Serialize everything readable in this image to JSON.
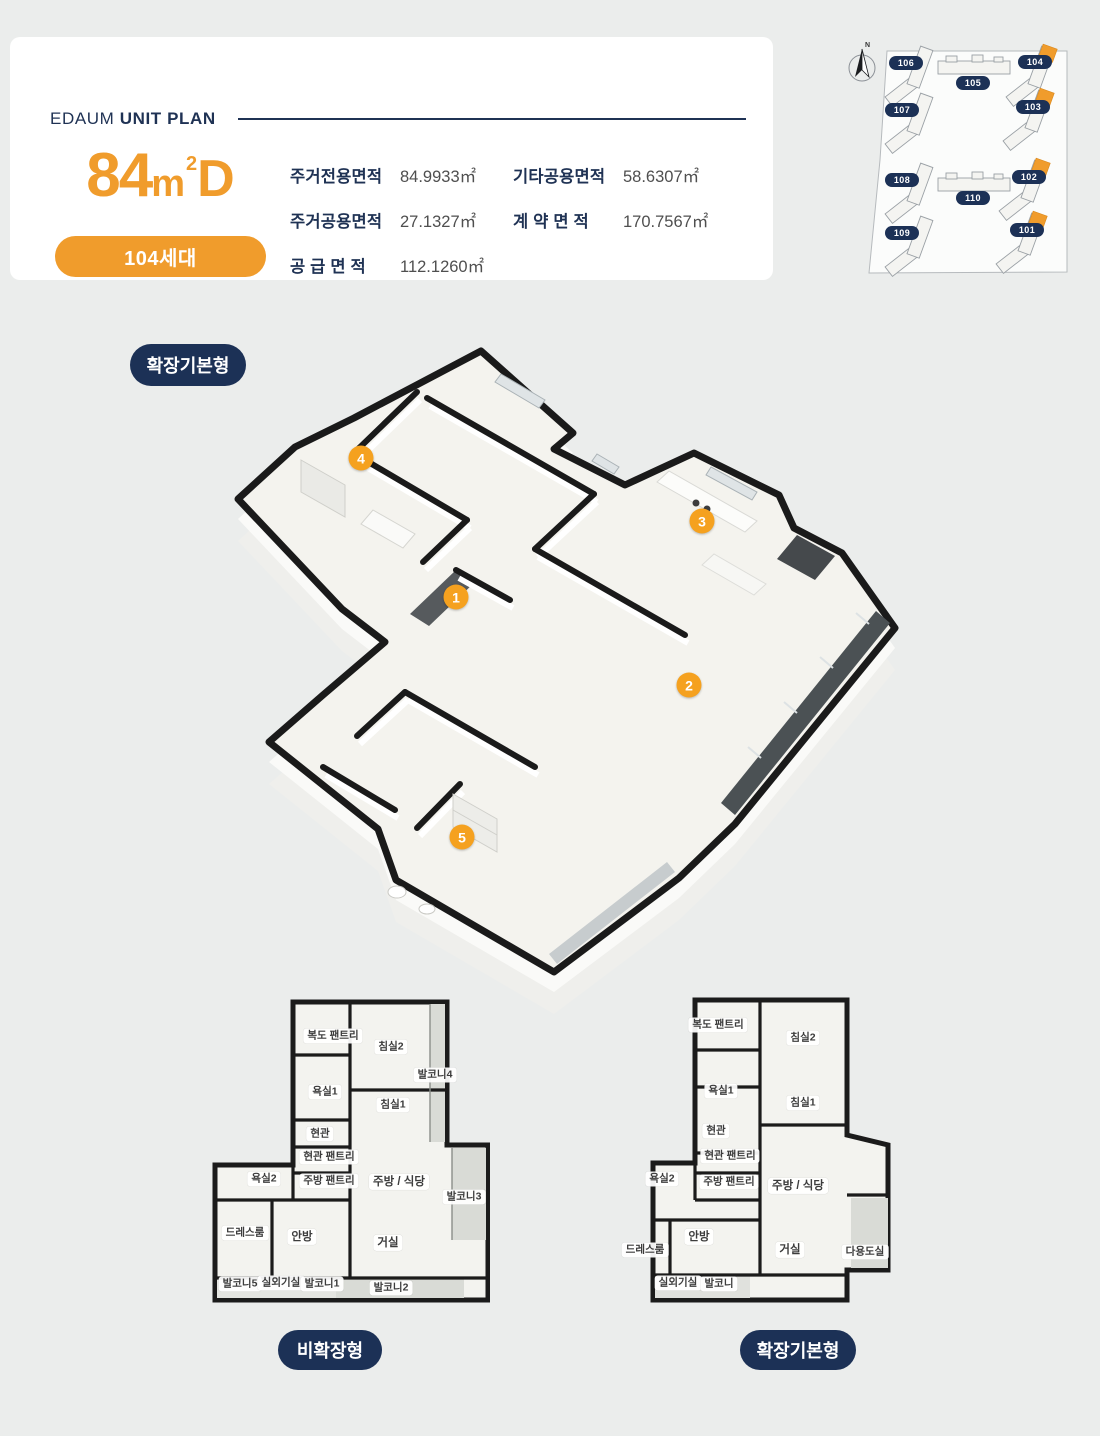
{
  "header": {
    "brand": "EDAUM",
    "title": "UNIT PLAN",
    "unit_size": "84",
    "unit_m": "m",
    "unit_sup": "2",
    "unit_type": "D",
    "households": "104세대",
    "areas": [
      {
        "label": "주거전용면적",
        "value": "84.9933㎡"
      },
      {
        "label": "기타공용면적",
        "value": "58.6307㎡"
      },
      {
        "label": "주거공용면적",
        "value": "27.1327㎡"
      },
      {
        "label": "계 약 면 적",
        "value": "170.7567㎡"
      },
      {
        "label": "공 급 면 적",
        "value": "112.1260㎡"
      }
    ]
  },
  "site_map": {
    "north": "N",
    "buildings": [
      "106",
      "105",
      "104",
      "107",
      "103",
      "108",
      "110",
      "102",
      "109",
      "101"
    ],
    "highlighted_buildings": [
      "104",
      "103",
      "102",
      "101"
    ]
  },
  "plan3d": {
    "badge": "확장기본형",
    "markers": [
      "1",
      "2",
      "3",
      "4",
      "5"
    ]
  },
  "plans": [
    {
      "badge": "비확장형",
      "rooms": [
        "복도 팬트리",
        "침실2",
        "발코니4",
        "욕실1",
        "침실1",
        "현관",
        "현관 팬트리",
        "욕실2",
        "주방 팬트리",
        "주방 / 식당",
        "발코니3",
        "드레스룸",
        "안방",
        "거실",
        "발코니5",
        "실외기실",
        "발코니1",
        "발코니2"
      ]
    },
    {
      "badge": "확장기본형",
      "rooms": [
        "복도 팬트리",
        "침실2",
        "욕실1",
        "침실1",
        "현관",
        "현관 팬트리",
        "욕실2",
        "주방 팬트리",
        "주방 / 식당",
        "드레스룸",
        "안방",
        "거실",
        "다용도실",
        "실외기실",
        "발코니"
      ]
    }
  ],
  "colors": {
    "navy": "#1C3156",
    "orange": "#F09C2C",
    "bg": "#EBEDEC"
  }
}
